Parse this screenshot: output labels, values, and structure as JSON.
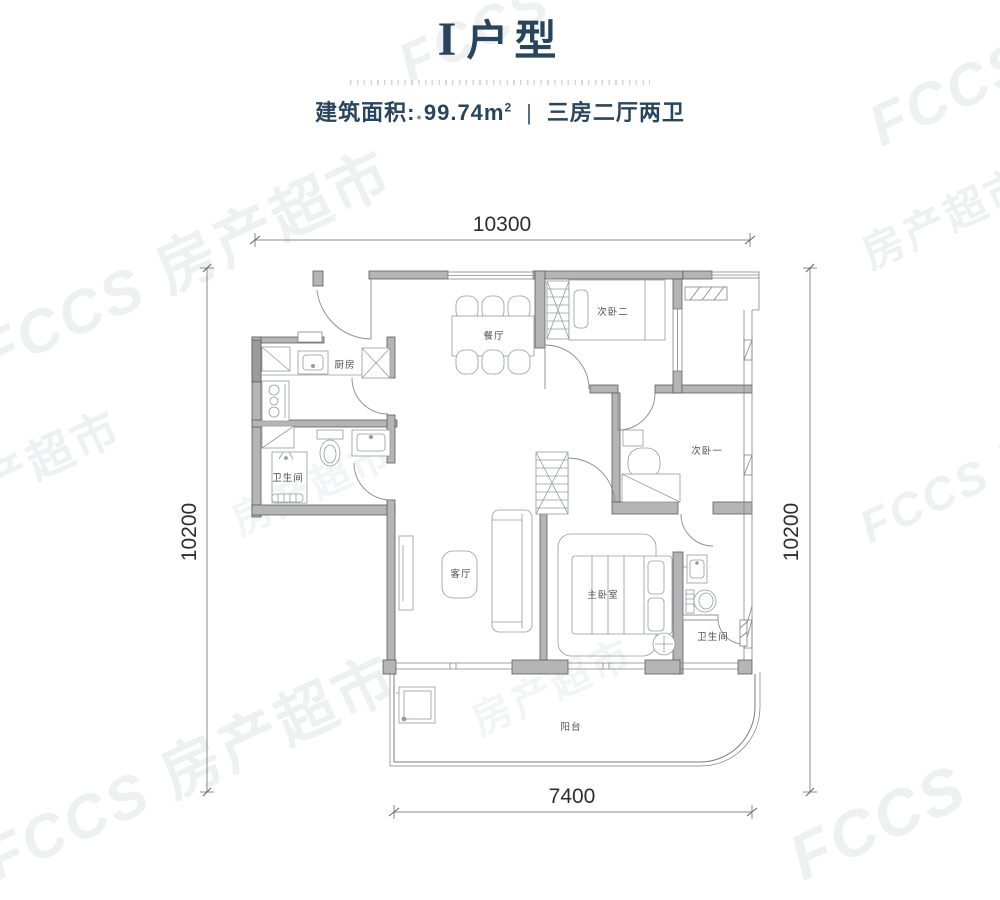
{
  "header": {
    "title_prefix": "I",
    "title_suffix": "户型",
    "area_label": "建筑面积:",
    "area_bullet": "●",
    "area_value": "99.74m",
    "area_superscript": "2",
    "separator": "|",
    "layout_spec": "三房二厅两卫"
  },
  "dimensions": {
    "top": "10300",
    "left": "10200",
    "right": "10200",
    "bottom": "7400"
  },
  "rooms": {
    "kitchen": "厨房",
    "bath1": "卫生间",
    "dining": "餐厅",
    "bedroom2": "次卧二",
    "bedroom1": "次卧一",
    "living": "客厅",
    "master": "主卧室",
    "bath2": "卫生间",
    "balcony": "阳台"
  },
  "watermark": {
    "logo": "FCCS",
    "text": "房产超市"
  },
  "colors": {
    "title_navy": "#28455f",
    "wall_gray": "#b5b5b5",
    "line_gray": "#6a6a6a",
    "dim_text": "#2e2e2e"
  }
}
